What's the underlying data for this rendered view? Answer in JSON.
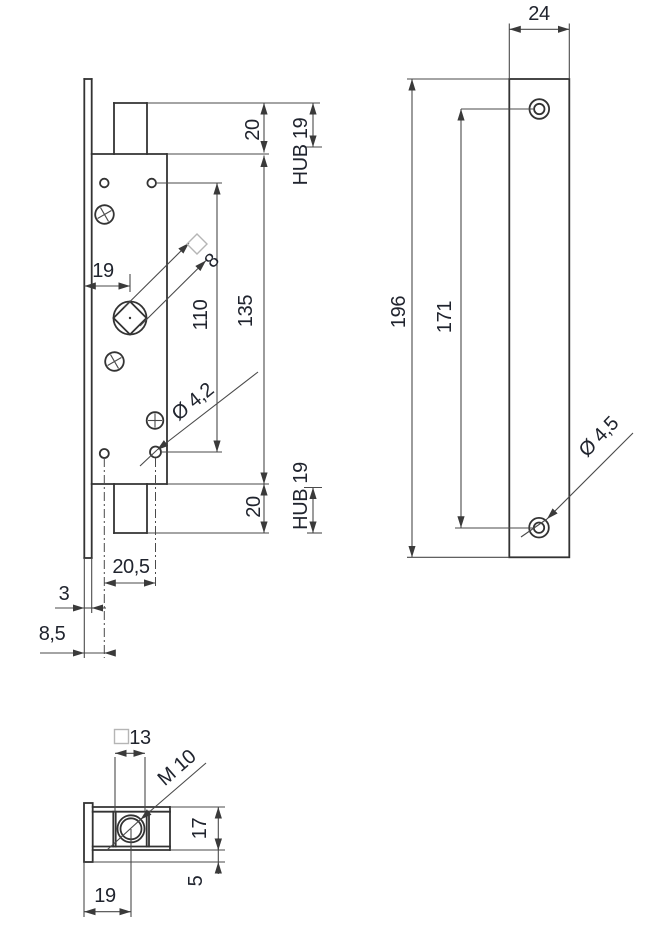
{
  "drawing": {
    "type": "technical-drawing-lock-mortise",
    "colors": {
      "outline": "#333333",
      "dimension_lines": "#4a4a4a",
      "text": "#20242e",
      "highlight_square": "#b5b5b5"
    },
    "front_view": {
      "dim_20_top": "20",
      "dim_hub_top": "HUB 19",
      "dim_135": "135",
      "dim_110": "110",
      "dim_19_backset": "19",
      "dim_8_square": "8",
      "dim_hole": "Ø 4,2",
      "dim_20_bottom": "20",
      "dim_hub_bottom": "HUB 19",
      "dim_20_5": "20,5",
      "dim_3": "3",
      "dim_8_5": "8,5"
    },
    "right_view": {
      "dim_24": "24",
      "dim_196": "196",
      "dim_171": "171",
      "dim_hole": "Ø 4,5"
    },
    "bottom_view": {
      "dim_13": "13",
      "dim_m10": "M 10",
      "dim_17": "17",
      "dim_5": "5",
      "dim_19": "19"
    }
  }
}
